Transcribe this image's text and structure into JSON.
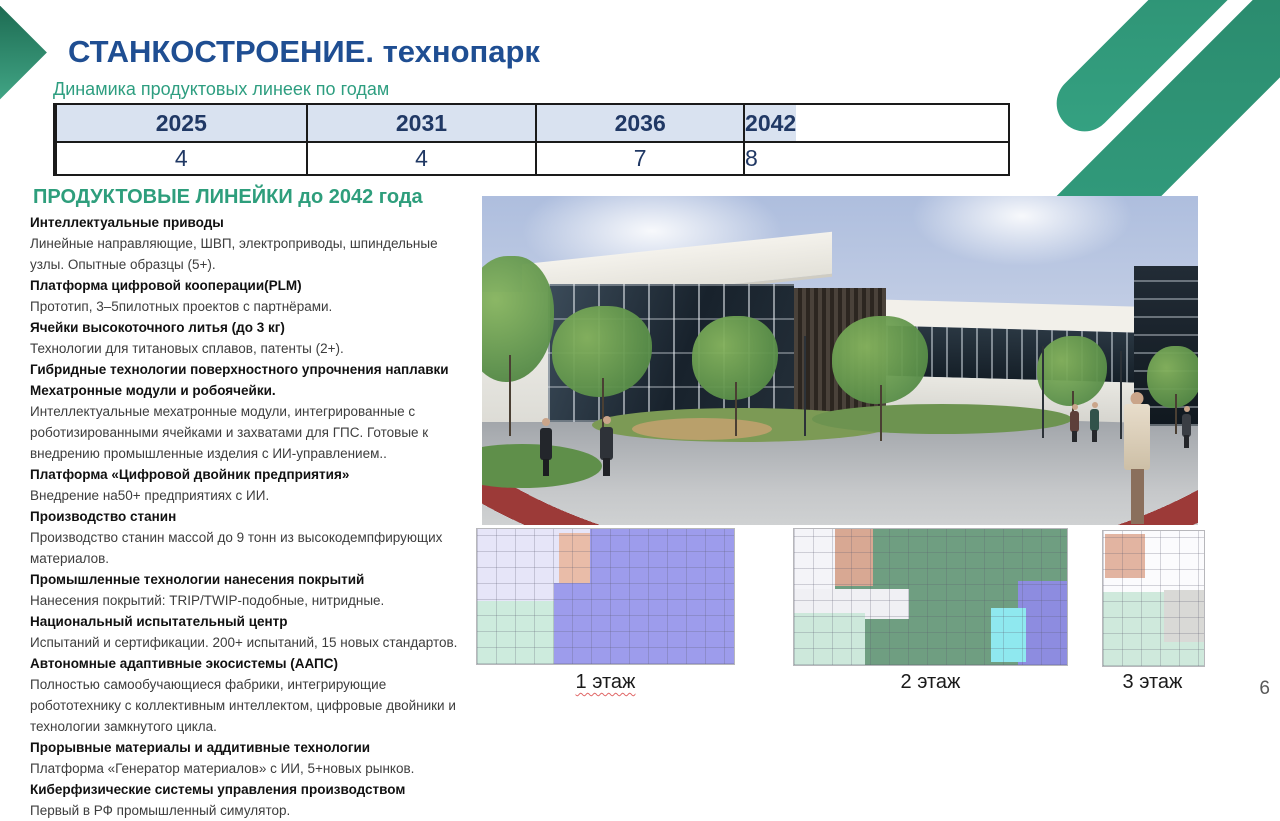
{
  "slide": {
    "title_main": "СТАНКОСТРОЕНИЕ.",
    "title_accent": " технопарк",
    "subtitle": "Динамика продуктовых линеек по годам",
    "page_number": "6"
  },
  "colors": {
    "title_navy": "#1f4e92",
    "table_navy": "#203864",
    "table_header_bg": "#d9e2f0",
    "accent_green": "#2e9e7c",
    "decoration_green": "#35a282",
    "red_path": "#9c3a38"
  },
  "table": {
    "years": [
      "2025",
      "2031",
      "2036",
      "2042"
    ],
    "values": [
      "4",
      "4",
      "7",
      "8"
    ]
  },
  "chart_data": {
    "type": "table",
    "title": "Динамика продуктовых линеек по годам",
    "categories": [
      "2025",
      "2031",
      "2036",
      "2042"
    ],
    "values": [
      4,
      4,
      7,
      8
    ]
  },
  "product_lines": {
    "heading": "ПРОДУКТОВЫЕ ЛИНЕЙКИ до 2042 года",
    "items": [
      {
        "bold": true,
        "text": "Интеллектуальные приводы"
      },
      {
        "bold": false,
        "text": "Линейные направляющие, ШВП, электроприводы, шпиндельные узлы. Опытные образцы (5+)."
      },
      {
        "bold": true,
        "text": "Платформа цифровой кооперации(PLM)"
      },
      {
        "bold": false,
        "text": "Прототип, 3–5пилотных проектов с партнёрами."
      },
      {
        "bold": true,
        "text": "Ячейки высокоточного литья (до 3 кг)"
      },
      {
        "bold": false,
        "text": "Технологии для титановых сплавов, патенты (2+)."
      },
      {
        "bold": true,
        "text": "Гибридные технологии поверхностного упрочнения наплавки"
      },
      {
        "bold": true,
        "text": "Мехатронные модули и робоячейки."
      },
      {
        "bold": false,
        "text": "Интеллектуальные мехатронные модули, интегрированные с роботизированными ячейками и захватами для ГПС. Готовые к внедрению промышленные изделия с ИИ-управлением.."
      },
      {
        "bold": true,
        "text": "Платформа «Цифровой двойник предприятия»"
      },
      {
        "bold": false,
        "text": "Внедрение на50+ предприятиях с ИИ."
      },
      {
        "bold": true,
        "text": "Производство станин"
      },
      {
        "bold": false,
        "text": "Производство станин массой до 9 тонн из высокодемпфирующих материалов."
      },
      {
        "bold": true,
        "text": "Промышленные технологии нанесения покрытий"
      },
      {
        "bold": false,
        "text": "Нанесения покрытий: TRIP/TWIP-подобные, нитридные."
      },
      {
        "bold": true,
        "text": "Национальный испытательный центр"
      },
      {
        "bold": false,
        "text": "Испытаний и сертификации. 200+ испытаний, 15 новых стандартов."
      },
      {
        "bold": true,
        "text": "Автономные адаптивные экосистемы (ААПС)"
      },
      {
        "bold": false,
        "text": "Полностью самообучающиеся фабрики, интегрирующие робототехнику с коллективным интеллектом, цифровые двойники и технологии замкнутого цикла."
      },
      {
        "bold": true,
        "text": "Прорывные материалы и аддитивные технологии"
      },
      {
        "bold": false,
        "text": "Платформа «Генератор материалов» с ИИ, 5+новых рынков."
      },
      {
        "bold": true,
        "text": "Киберфизические системы управления производством"
      },
      {
        "bold": false,
        "text": "Первый в РФ промышленный симулятор."
      }
    ]
  },
  "floor_plans": [
    {
      "label": "1 этаж"
    },
    {
      "label": "2 этаж"
    },
    {
      "label": "3 этаж"
    }
  ]
}
